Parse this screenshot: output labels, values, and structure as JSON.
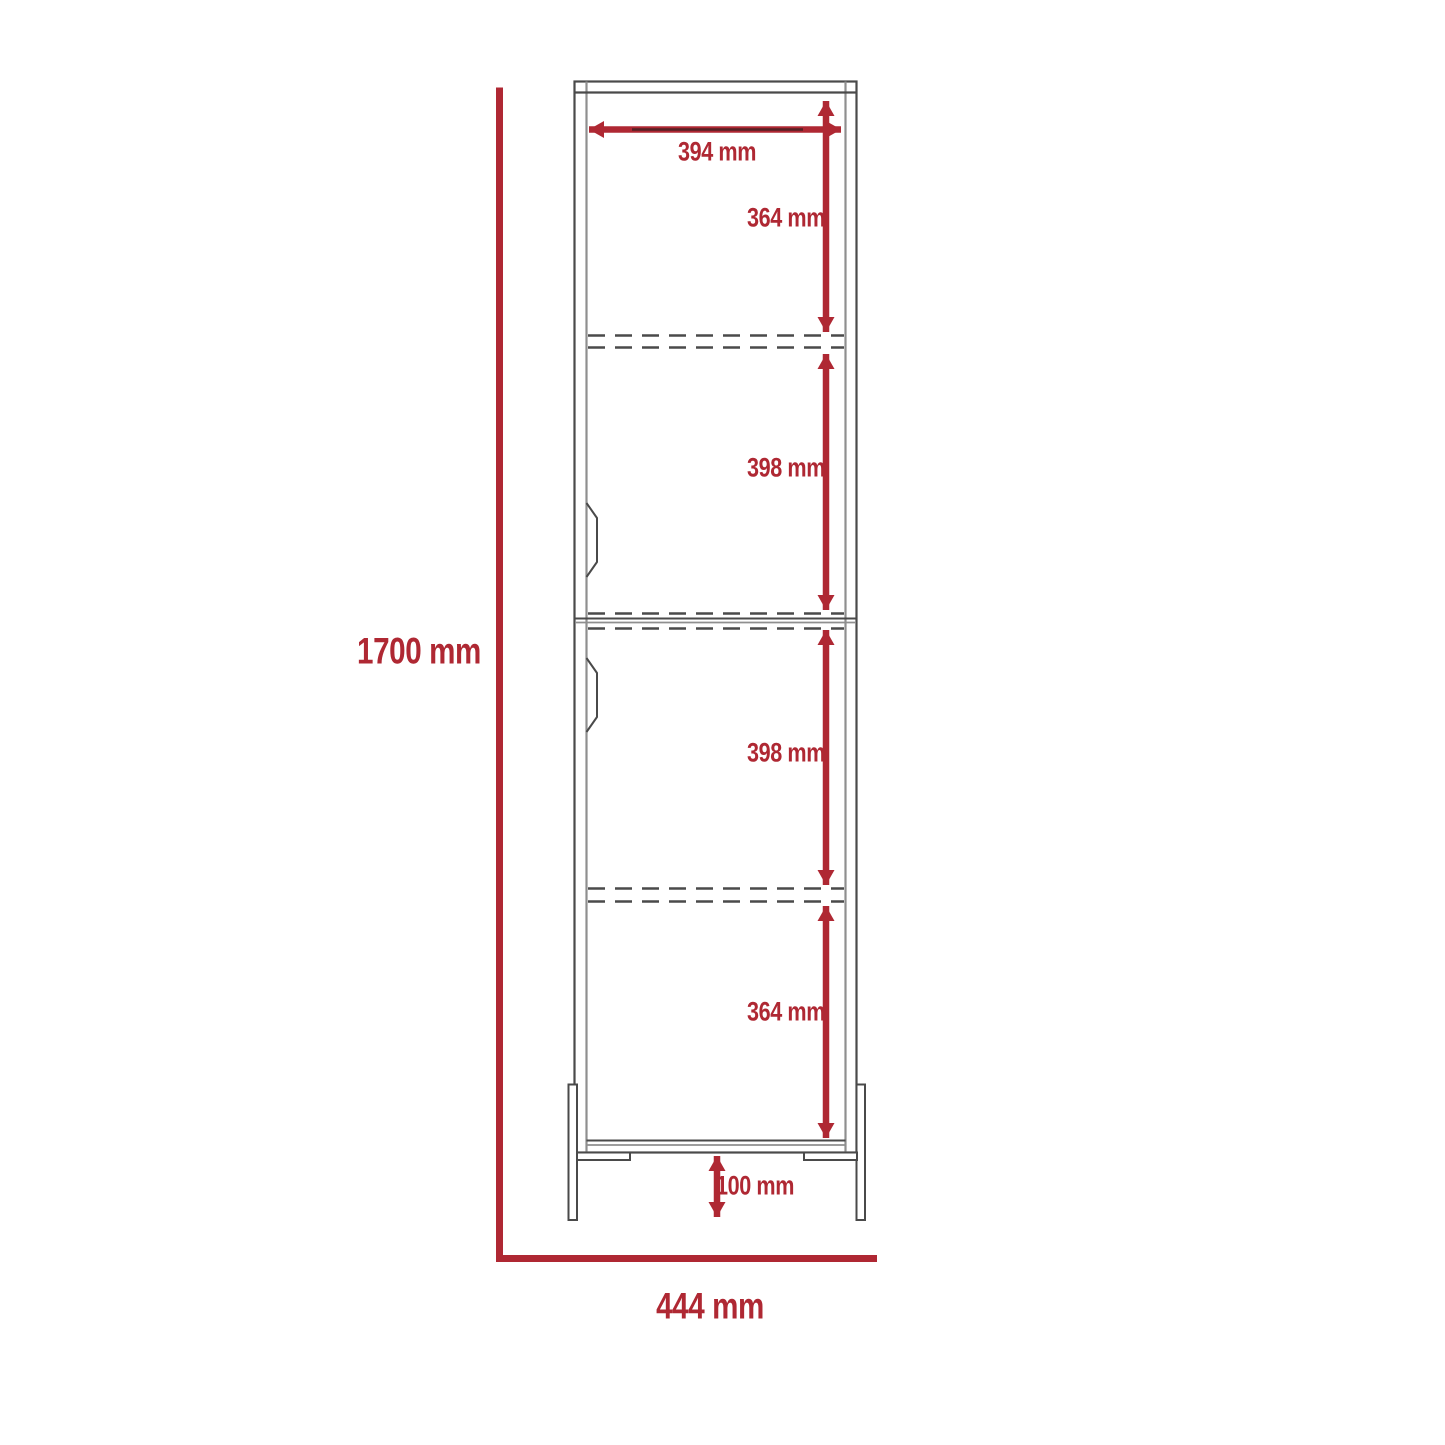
{
  "drawing": {
    "accent_color": "#AF2833",
    "line_color": "#4A4A4A",
    "labels": {
      "interior_width": "394 mm",
      "top_section": "364 mm",
      "upper_middle_section": "398 mm",
      "lower_middle_section": "398 mm",
      "bottom_section": "364 mm",
      "foot_clearance": "100 mm",
      "overall_height": "1700 mm",
      "overall_width": "444 mm"
    }
  }
}
